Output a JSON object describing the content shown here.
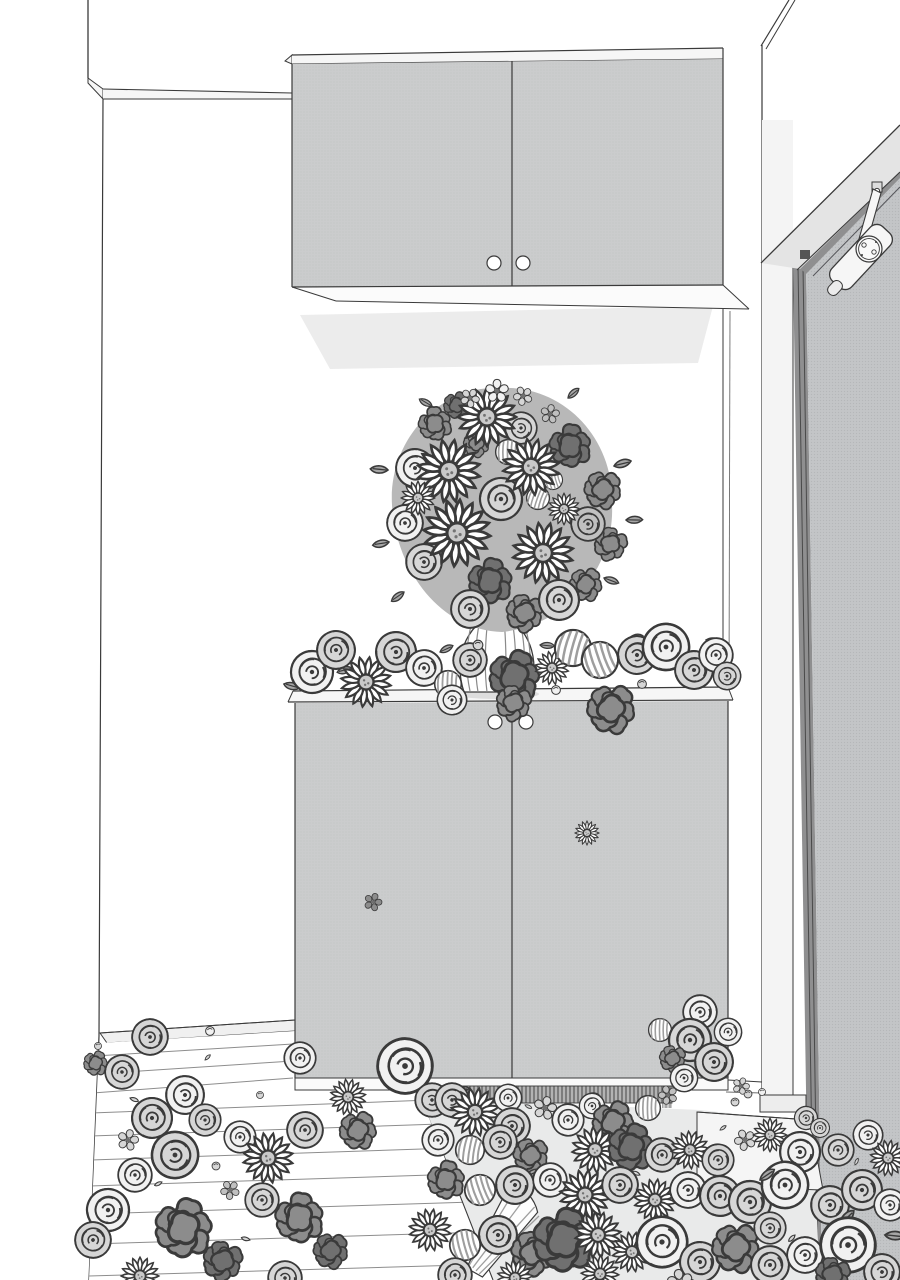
{
  "meta": {
    "title": "Black-and-white manga illustration: apartment entryway (genkan) overflowing with flowers",
    "style": "screentone line art, no text, no UI elements"
  },
  "palette": {
    "line": "#3a3a3a",
    "wall": "#ffffff",
    "cabinet": "#cbcccd",
    "cabinetTop": "#f6f6f6",
    "underside": "#fbfbfb",
    "wallShadow": "#ececec",
    "door": "#c3c5c7",
    "doorEdge": "#8f8f90",
    "jamb": "#f4f4f4",
    "jambShade": "#e4e4e4",
    "tataki": "#e9eaea",
    "step": "#f5f5f5",
    "plinthShadow": "#b3b3b3",
    "hatchLine": "#6f6f6f",
    "plankLine": "#8d8d8d",
    "roseLight": "#f1f1f1",
    "roseMid": "#d6d6d6",
    "roseGray": "#c0c0c0",
    "flowerDark": "#8c8c8c",
    "flowerDarker": "#707070",
    "daisyCenter": "#c9c9c9",
    "mumStripe": "#9e9e9e",
    "leaf": "#a6a6a6",
    "bouquetBase": "#b8b8b8",
    "vaseStripe": "#8a8a8a",
    "closerBody": "#f6f6f6"
  },
  "scene": {
    "setting": "Japanese entryway seen from a low angle",
    "elements": [
      "ceiling corner lines at upper left and upper right",
      "white back wall",
      "wall-mounted upper cabinet with two doors and two round knobs",
      "soft shadow on wall under upper cabinet",
      "sliver of right-hand wall and door frame",
      "dark entry door with overhead door-closer arm",
      "large round bouquet of daisies, roses and peonies in a striped vase",
      "shoe cabinet with two doors and two round knobs",
      "flowers heaped across the shoe cabinet top, spilling over the edge",
      "one small daisy and one small dark blossom stuck on the cabinet doors",
      "wooden plank floor at lower left",
      "step edge down to the entry floor",
      "entry floor carpeted with roses, daisies, dark peonies and mums",
      "fallen striped bouquet wrapping among the flowers"
    ],
    "flower_types": [
      "daisy",
      "rose",
      "peony",
      "striped chrysanthemum",
      "five-petal blossom",
      "bud",
      "leaf",
      "petal"
    ],
    "counts": {
      "upper_cabinet_knobs": 2,
      "lower_cabinet_knobs": 2,
      "cabinet_door_decal_flowers": 2
    }
  }
}
